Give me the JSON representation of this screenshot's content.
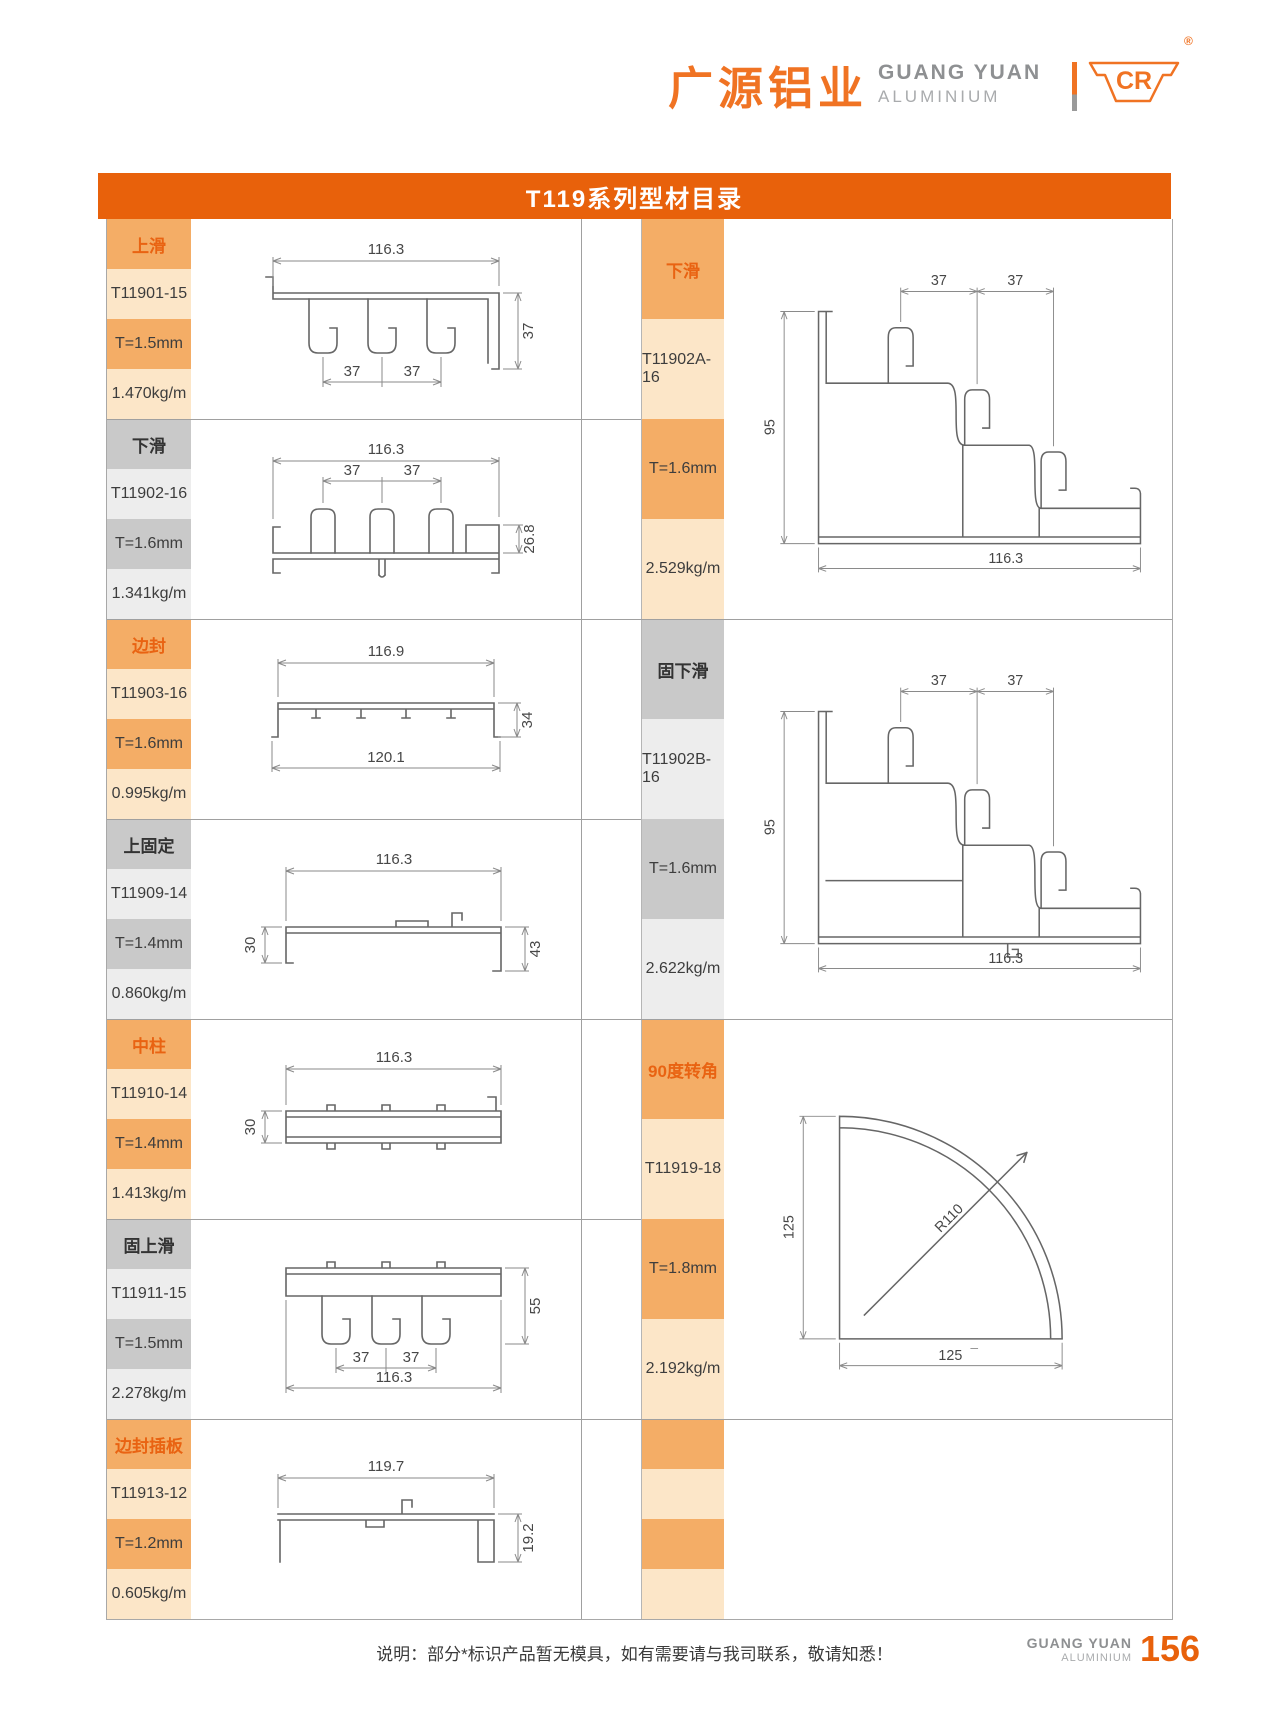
{
  "header": {
    "logo_cn": "广源铝业",
    "logo_en_top": "GUANG YUAN",
    "logo_en_bottom": "ALUMINIUM",
    "logo_mark": "CR",
    "registered": "®"
  },
  "title": "T119系列型材目录",
  "left_entries": [
    {
      "theme": "orange",
      "category": "上滑",
      "code": "T11901-15",
      "thickness": "T=1.5mm",
      "weight": "1.470kg/m",
      "dims": {
        "top": "116.3",
        "right": "37",
        "b1": "37",
        "b2": "37"
      }
    },
    {
      "theme": "gray",
      "category": "下滑",
      "code": "T11902-16",
      "thickness": "T=1.6mm",
      "weight": "1.341kg/m",
      "dims": {
        "top": "116.3",
        "m1": "37",
        "m2": "37",
        "right": "26.8"
      }
    },
    {
      "theme": "orange",
      "category": "边封",
      "code": "T11903-16",
      "thickness": "T=1.6mm",
      "weight": "0.995kg/m",
      "dims": {
        "top": "116.9",
        "right": "34",
        "bottom": "120.1"
      }
    },
    {
      "theme": "gray",
      "category": "上固定",
      "code": "T11909-14",
      "thickness": "T=1.4mm",
      "weight": "0.860kg/m",
      "dims": {
        "top": "116.3",
        "left": "30",
        "right": "43"
      }
    },
    {
      "theme": "orange",
      "category": "中柱",
      "code": "T11910-14",
      "thickness": "T=1.4mm",
      "weight": "1.413kg/m",
      "dims": {
        "top": "116.3",
        "left": "30"
      }
    },
    {
      "theme": "gray",
      "category": "固上滑",
      "code": "T11911-15",
      "thickness": "T=1.5mm",
      "weight": "2.278kg/m",
      "dims": {
        "right": "55",
        "b1": "37",
        "b2": "37",
        "bottom": "116.3"
      }
    },
    {
      "theme": "orange",
      "category": "边封插板",
      "code": "T11913-12",
      "thickness": "T=1.2mm",
      "weight": "0.605kg/m",
      "dims": {
        "top": "119.7",
        "right": "19.2"
      }
    }
  ],
  "right_entries": [
    {
      "theme": "orange",
      "category": "下滑",
      "code": "T11902A-16",
      "thickness": "T=1.6mm",
      "weight": "2.529kg/m",
      "dims": {
        "t1": "37",
        "t2": "37",
        "left": "95",
        "bottom": "116.3"
      }
    },
    {
      "theme": "gray",
      "category": "固下滑",
      "code": "T11902B-16",
      "thickness": "T=1.6mm",
      "weight": "2.622kg/m",
      "dims": {
        "t1": "37",
        "t2": "37",
        "left": "95",
        "bottom": "116.3"
      }
    },
    {
      "theme": "orange",
      "category": "90度转角",
      "code": "T11919-18",
      "thickness": "T=1.8mm",
      "weight": "2.192kg/m",
      "dims": {
        "left": "125",
        "radius": "R110",
        "bottom": "125"
      }
    }
  ],
  "footer": {
    "note": "说明：部分*标识产品暂无模具，如有需要请与我司联系，敬请知悉！",
    "brand_top": "GUANG YUAN",
    "brand_bottom": "ALUMINIUM",
    "page_number": "156"
  },
  "colors": {
    "accent_orange": "#E8610B",
    "brand_orange": "#F07323",
    "cell_orange_dark": "#F4AD66",
    "cell_orange_light": "#FCE6C8",
    "cell_gray_dark": "#C9C9C9",
    "cell_gray_light": "#EDEDED"
  }
}
